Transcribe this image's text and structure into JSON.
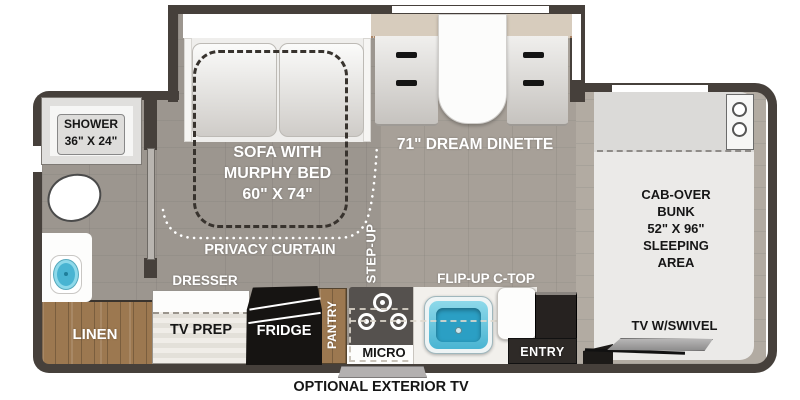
{
  "floorplan": {
    "type": "RV class-C motorhome floor plan",
    "labels": {
      "shower": "SHOWER\n36\" X 24\"",
      "sofa": "SOFA WITH\nMURPHY BED\n60\" X 74\"",
      "dinette": "71\" DREAM DINETTE",
      "privacy_curtain": "PRIVACY CURTAIN",
      "step_up": "STEP-UP",
      "dresser": "DRESSER",
      "tv_prep": "TV PREP",
      "fridge": "FRIDGE",
      "pantry": "PANTRY",
      "micro": "MICRO",
      "flip_up_ctop": "FLIP-UP C-TOP",
      "entry": "ENTRY",
      "linen": "LINEN",
      "cab_over_bunk": "CAB-OVER\nBUNK\n52\" X 96\"\nSLEEPING\nAREA",
      "tv_swivel": "TV W/SWIVEL",
      "exterior_tv": "OPTIONAL EXTERIOR TV"
    }
  },
  "colors": {
    "wall": "#46403b",
    "floor_rear": "#9c968f",
    "floor_front": "#a7a098",
    "floor_cab": "#b2aba2",
    "wood": "#9c7850",
    "slide_tan": "#d7ccbd",
    "sink_blue": "#49b4d2",
    "sink_blue_light": "#8ed9ea",
    "bunk_light": "#ebeae8",
    "bunk_shade": "#dbdad8",
    "fridge_black": "#161412",
    "stove_gray": "#55514e",
    "entry_dark": "#262220",
    "tv_gray": "#a3a2a2",
    "label_light": "#ffffff",
    "label_dark": "#161616"
  }
}
